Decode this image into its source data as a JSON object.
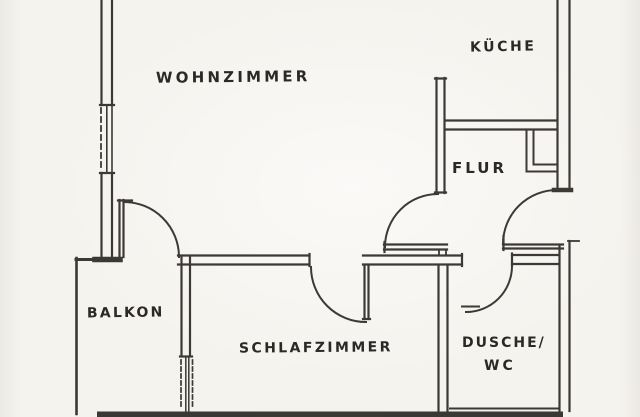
{
  "theme": {
    "background": "#f5f3ee",
    "ink": "#2e2b28",
    "label_color": "#2b2826"
  },
  "plan": {
    "type": "apartment-floor-plan",
    "labels": {
      "wohnzimmer": "WOHNZIMMER",
      "kueche": "KÜCHE",
      "flur": "FLUR",
      "balkon": "BALKON",
      "schlafzimmer": "SCHLAFZIMMER",
      "dusche_line1": "DUSCHE/",
      "dusche_line2": "WC"
    }
  }
}
